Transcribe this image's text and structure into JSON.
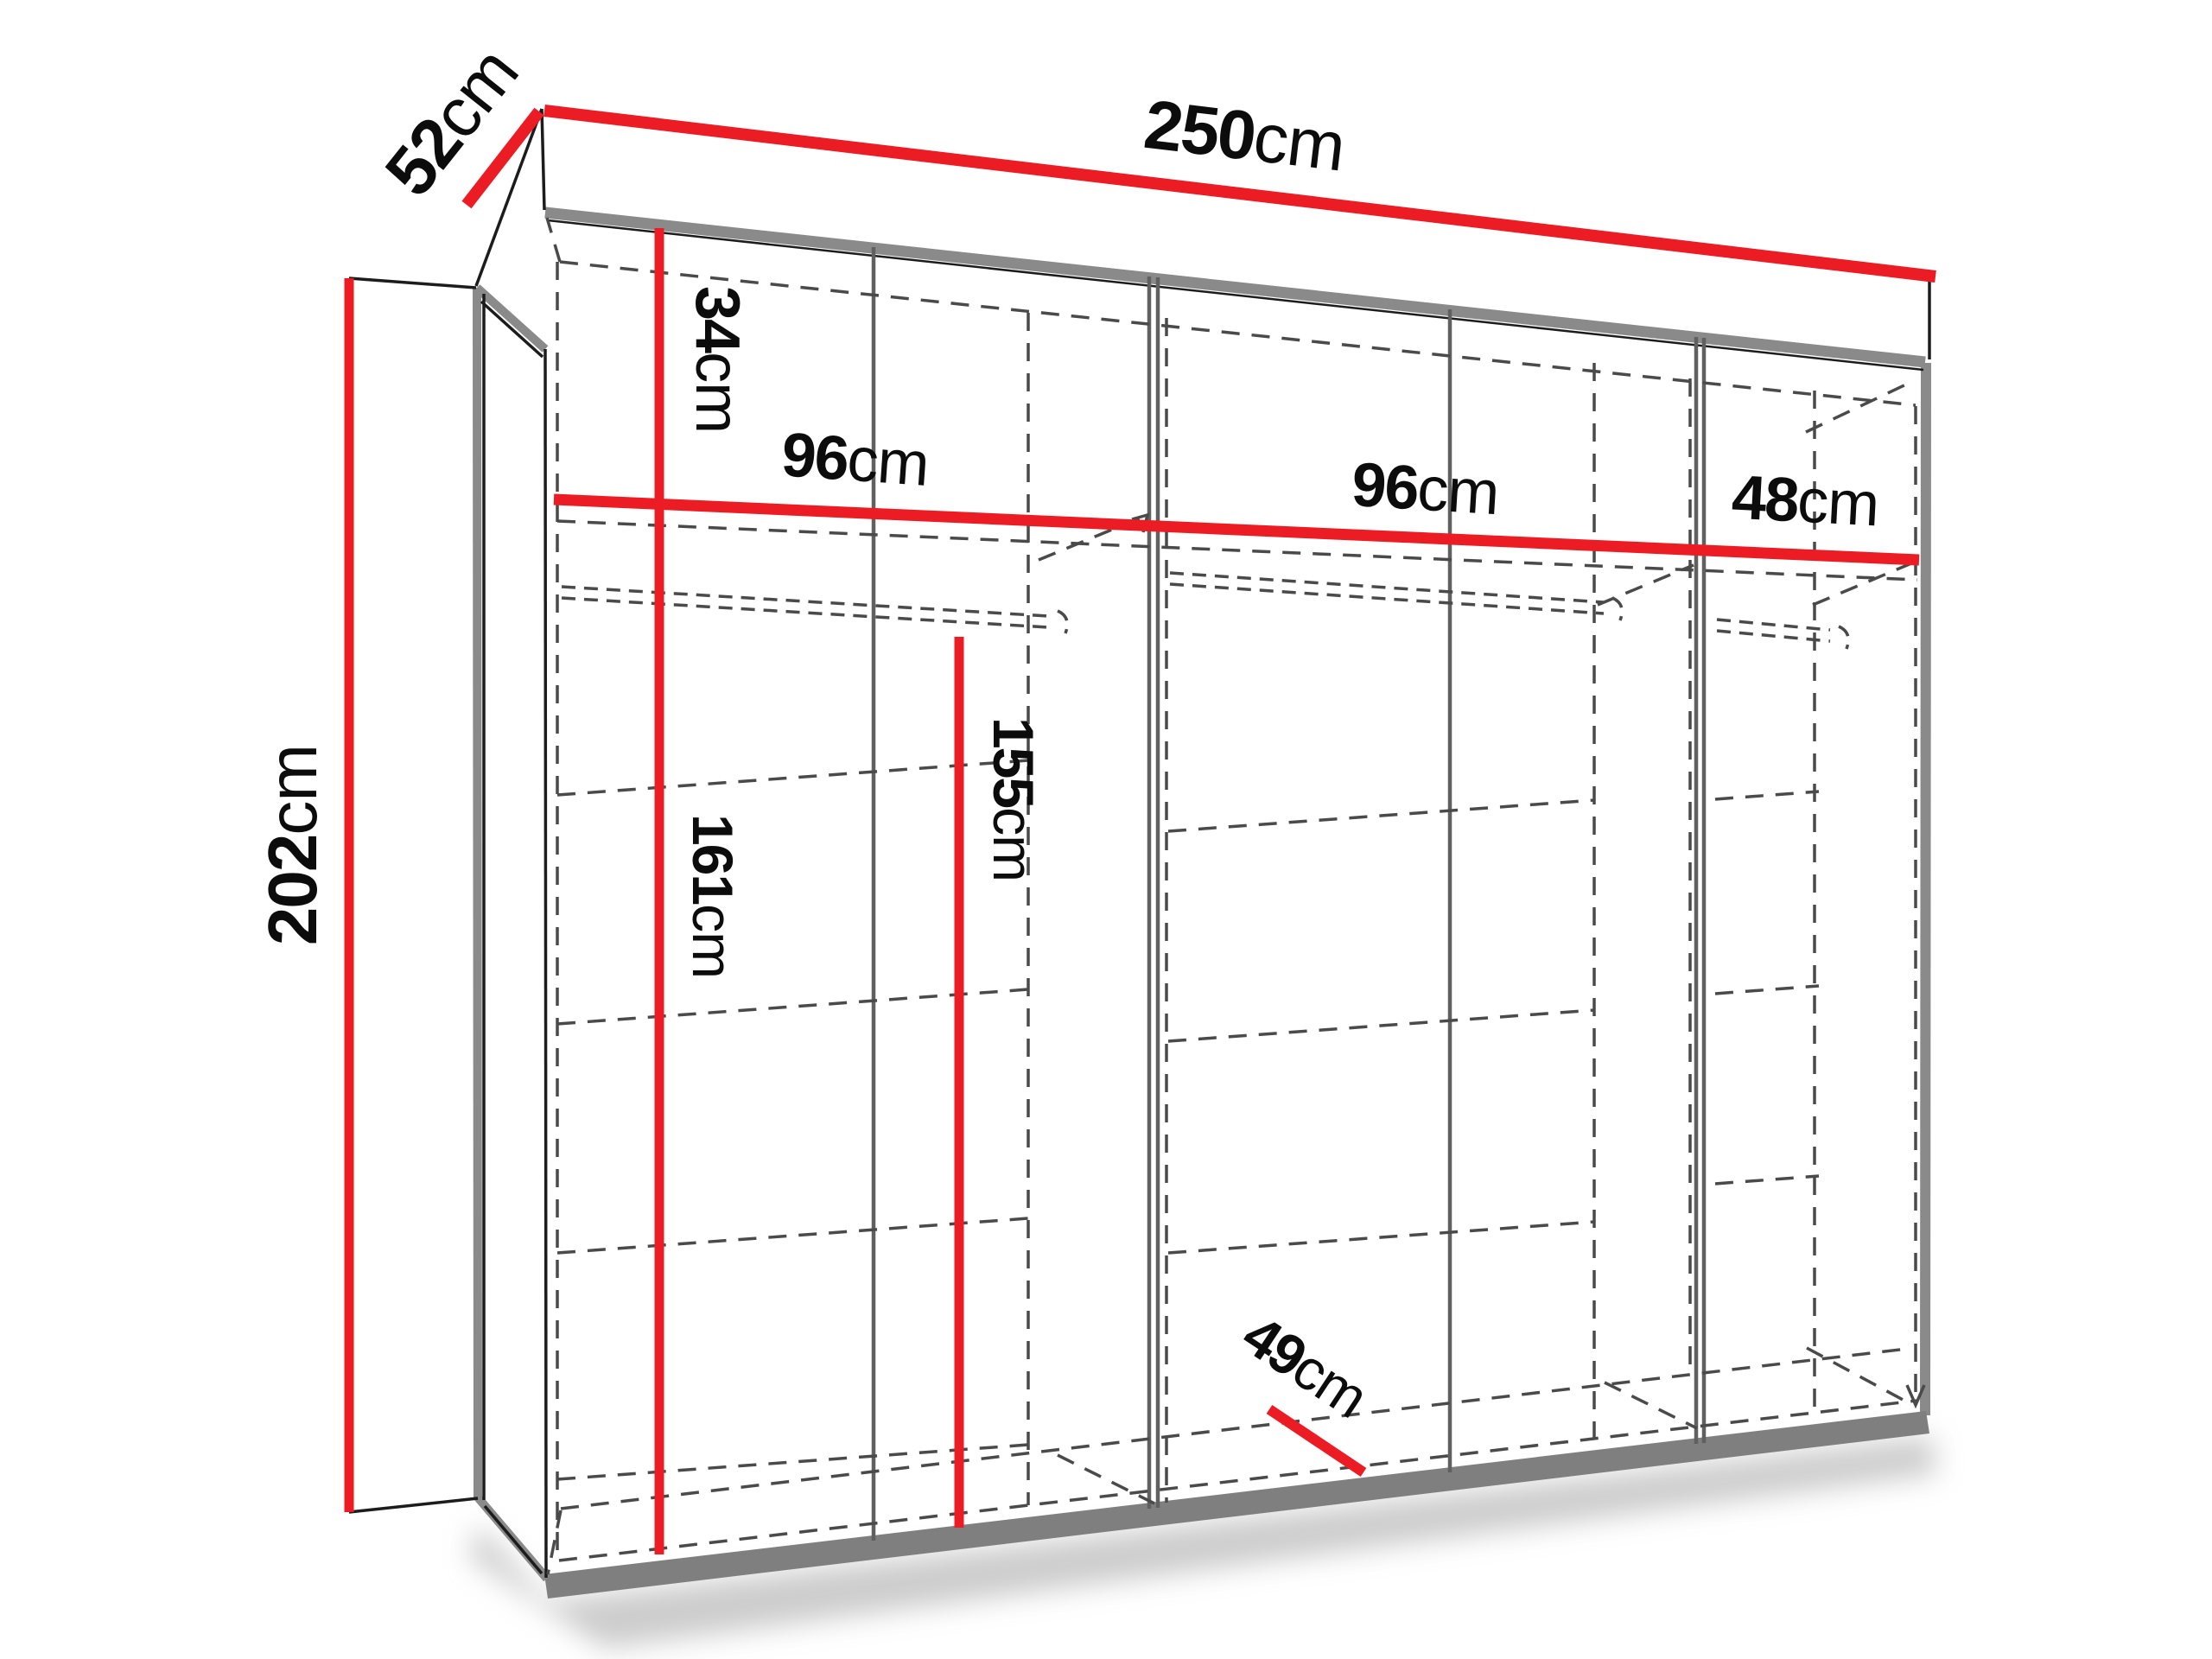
{
  "diagram": {
    "title": "wardrobe dimension diagram",
    "unit": "cm",
    "colors": {
      "accent_red": "#ec1c24",
      "edge_gray": "#8a8a8a",
      "dash_gray": "#4a4a4a",
      "text_black": "#0c0c0c"
    },
    "dimensions": {
      "total_width": {
        "value": "250",
        "unit": "cm"
      },
      "top_depth": {
        "value": "52",
        "unit": "cm"
      },
      "total_height": {
        "value": "202",
        "unit": "cm"
      },
      "top_section_height": {
        "value": "34",
        "unit": "cm"
      },
      "left_section_width": {
        "value": "96",
        "unit": "cm"
      },
      "mid_section_width": {
        "value": "96",
        "unit": "cm"
      },
      "right_section_width": {
        "value": "48",
        "unit": "cm"
      },
      "left_inner_height": {
        "value": "161",
        "unit": "cm"
      },
      "mid_inner_height": {
        "value": "155",
        "unit": "cm"
      },
      "floor_depth": {
        "value": "49",
        "unit": "cm"
      }
    }
  }
}
